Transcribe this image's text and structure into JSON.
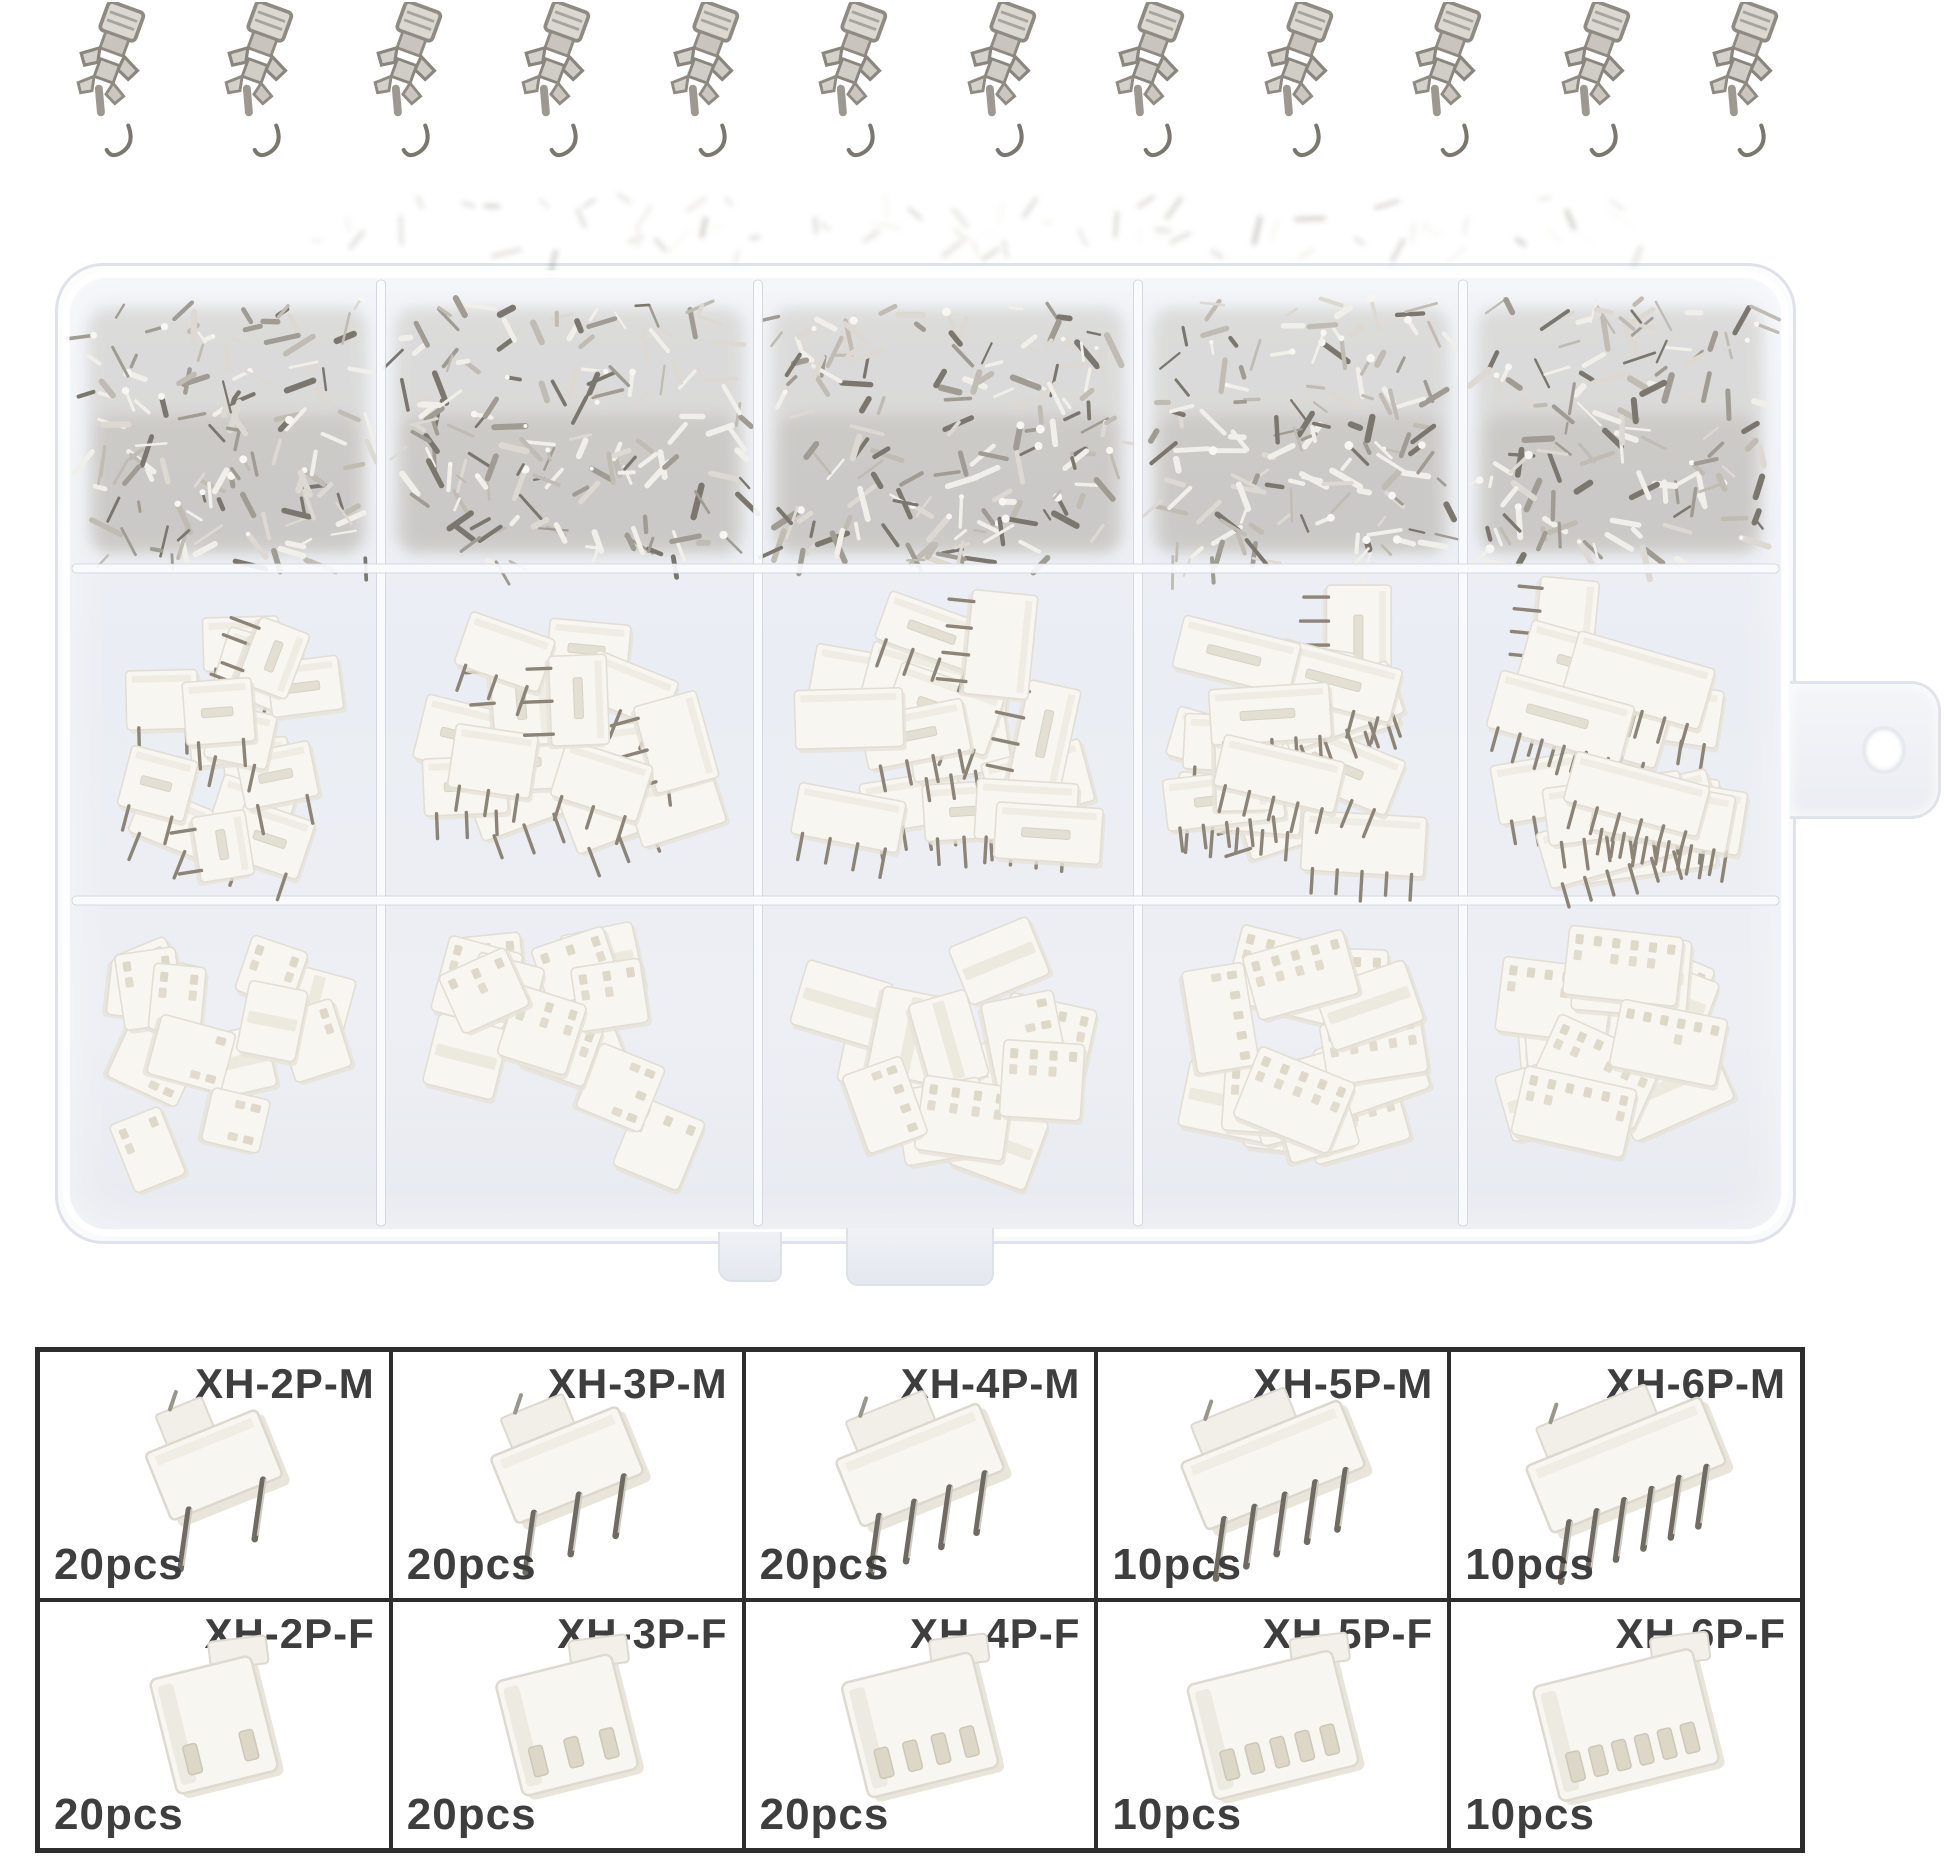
{
  "background": "#ffffff",
  "palette": {
    "metal_light": "#f1efe9",
    "metal_mid": "#c0bcb3",
    "metal_dark": "#7b776e",
    "plastic_white": "#f8f6f1",
    "plastic_edge": "#e2ded4",
    "slot_tan": "#d9d2c1",
    "box_tint": "#edeff4",
    "box_edge": "#dfe2ea",
    "grid_border": "#2d2d2d",
    "label_color": "#3e3e3e"
  },
  "loose_terminals": {
    "icon": "crimp-terminal-icon",
    "count": 12
  },
  "organizer_box": {
    "top_row": {
      "compartments": 5,
      "contents": "bulk-crimp-terminals"
    },
    "middle_row": {
      "compartments": 5,
      "contents": "male-headers",
      "pins_per_compartment": [
        2,
        3,
        4,
        5,
        6
      ]
    },
    "bottom_row": {
      "compartments": 5,
      "contents": "female-housings",
      "pins_per_compartment": [
        2,
        3,
        4,
        5,
        6
      ]
    }
  },
  "spec_grid": {
    "rows": [
      {
        "name": "male-headers",
        "cells": [
          {
            "label": "XH-2P-M",
            "count": "20pcs",
            "pins": 2,
            "type": "male"
          },
          {
            "label": "XH-3P-M",
            "count": "20pcs",
            "pins": 3,
            "type": "male"
          },
          {
            "label": "XH-4P-M",
            "count": "20pcs",
            "pins": 4,
            "type": "male"
          },
          {
            "label": "XH-5P-M",
            "count": "10pcs",
            "pins": 5,
            "type": "male"
          },
          {
            "label": "XH-6P-M",
            "count": "10pcs",
            "pins": 6,
            "type": "male"
          }
        ]
      },
      {
        "name": "female-housings",
        "cells": [
          {
            "label": "XH-2P-F",
            "count": "20pcs",
            "pins": 2,
            "type": "female"
          },
          {
            "label": "XH-3P-F",
            "count": "20pcs",
            "pins": 3,
            "type": "female"
          },
          {
            "label": "XH-4P-F",
            "count": "20pcs",
            "pins": 4,
            "type": "female"
          },
          {
            "label": "XH-5P-F",
            "count": "10pcs",
            "pins": 5,
            "type": "female"
          },
          {
            "label": "XH-6P-F",
            "count": "10pcs",
            "pins": 6,
            "type": "female"
          }
        ]
      }
    ]
  }
}
